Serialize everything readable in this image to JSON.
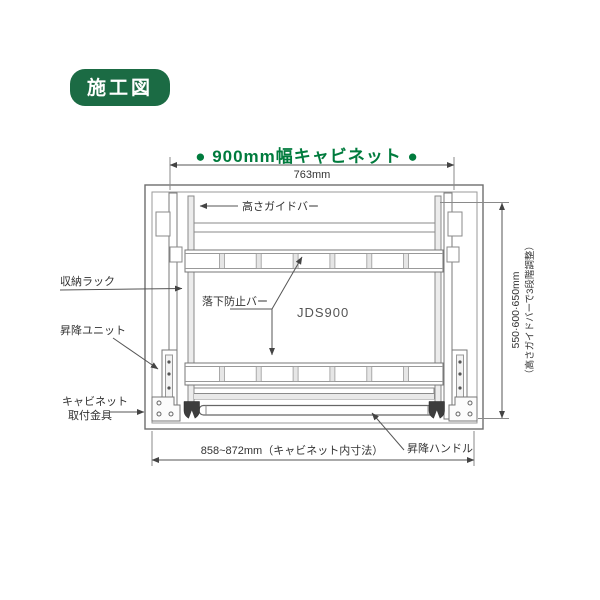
{
  "badge": {
    "label": "施工図",
    "bg_color": "#1b6b44",
    "text_color": "#ffffff"
  },
  "header": {
    "title": "● 900mm幅キャビネット ●",
    "color": "#007b3d"
  },
  "diagram": {
    "model": "JDS900",
    "dimensions": {
      "top_width": "763mm",
      "bottom_width": "858~872mm（キャビネット内寸法）",
      "height_values": "550·600·650mm",
      "height_note": "（高さガイドバーで3段階調整）"
    },
    "labels": {
      "height_guide_bar": "高さガイドバー",
      "storage_rack": "収納ラック",
      "lift_unit": "昇降ユニット",
      "mount_bracket_line1": "キャビネット",
      "mount_bracket_line2": "取付金具",
      "fall_prevention_bar": "落下防止バー",
      "lift_handle": "昇降ハンドル"
    },
    "line_color": "#7a7a7a",
    "caster_color": "#3d3d3d"
  }
}
